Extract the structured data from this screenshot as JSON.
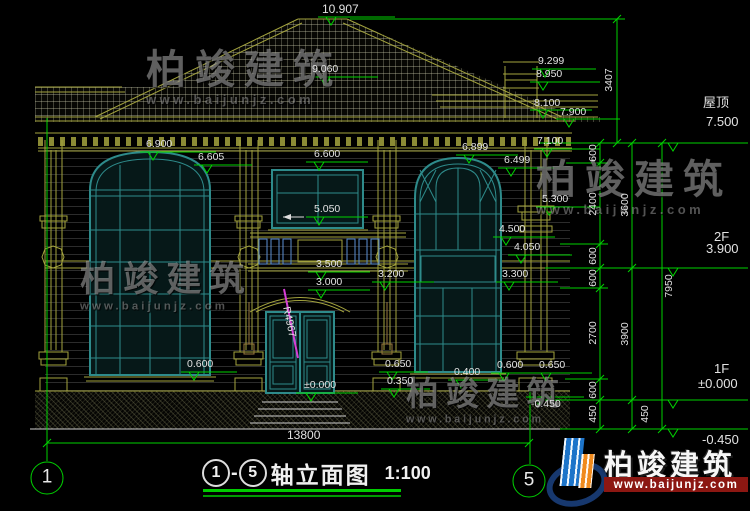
{
  "watermark": {
    "brand": "柏竣建筑",
    "url": "www.baijunjz.com"
  },
  "logo": {
    "brand": "柏竣建筑",
    "url": "www.baijunjz.com"
  },
  "title_bar": {
    "axis_start": "1",
    "dash": "-",
    "axis_end": "5",
    "name": "轴立面图",
    "scale": "1:100"
  },
  "axes": {
    "left_bubble": "1",
    "right_bubble": "5"
  },
  "floor_markers": {
    "roof": {
      "label": "屋顶",
      "elev": "7.500"
    },
    "f2": {
      "label": "2F",
      "elev": "3.900"
    },
    "f1": {
      "label": "1F",
      "elev": "±0.000"
    },
    "ground": {
      "elev": "-0.450"
    }
  },
  "elevations": {
    "ridge": "10.907",
    "sub_ridge": "9.060",
    "chimney_top": "9.299",
    "chimney_band": "8.950",
    "wing_ridge": "8.100",
    "wing_eave": "7.900",
    "main_eave": "7.100",
    "left_cornice": "6.900",
    "left_window_arch": "6.605",
    "center_window_top": "6.600",
    "center_window_sill": "5.050",
    "balcony_rail": "3.500",
    "porch_roof": "3.200",
    "door_arch": "3.000",
    "door_sill": "±0.000",
    "right_cornice": "6.899",
    "right_window_arch": "6.499",
    "right_capital": "5.300",
    "right_window_mid": "4.500",
    "right_sill": "4.050",
    "right_band": "3.300",
    "base_left": "0.600",
    "porch_step_top": "0.650",
    "porch_step_mid": "0.350",
    "base_right_a": "0.400",
    "base_right_b": "0.600",
    "base_right_c": "0.650",
    "ground_line": "-0.450"
  },
  "dimensions": {
    "roof_height": "3407",
    "inner_chain": [
      "600",
      "2400",
      "600",
      "600",
      "2700",
      "600",
      "450"
    ],
    "mid_chain": [
      "3600",
      "3900",
      "450"
    ],
    "total_height": "7950",
    "total_width": "13800"
  },
  "annotations": {
    "door_radius": "R4967"
  },
  "colors": {
    "cad_green": "#00d200",
    "cad_olive": "#a3a33e",
    "window_teal": "#2e8b8b",
    "baluster_blue": "#5b8fd4",
    "radius_magenta": "#d63fd6",
    "logo_blue": "#1d74c9",
    "logo_orange": "#f08a1d",
    "logo_red": "#8c1712",
    "title_underline": "#00cc00"
  }
}
